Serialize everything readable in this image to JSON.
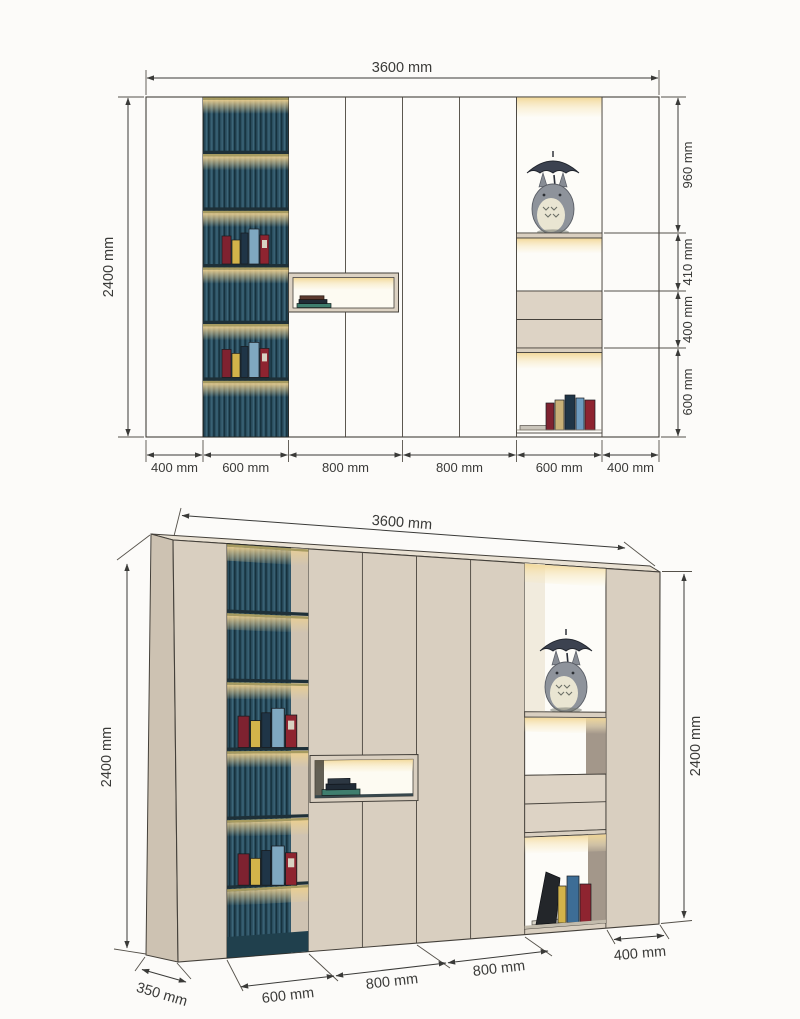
{
  "page": {
    "title": "Wall cabinet dimension drawing"
  },
  "colors": {
    "outline": "#44403a",
    "panel_beige": "#dcd2c3",
    "panel_shadow": "#cdc2b2",
    "slat_teal": "#2d5163",
    "slat_dark": "#16323e",
    "glow_yellow": "#f2d795",
    "niche_white": "#fdfcf8",
    "inner_wall_shadow": "#a3978a",
    "shelf_board_dark": "#1e3038",
    "dim_text": "#3a3a38"
  },
  "elevation": {
    "dim_width": "3600 mm",
    "dim_height": "2400 mm",
    "right_dims": [
      "960 mm",
      "410 mm",
      "400 mm",
      "600 mm"
    ],
    "bottom_dims": [
      "400 mm",
      "600 mm",
      "800 mm",
      "800 mm",
      "600 mm",
      "400 mm"
    ]
  },
  "perspective": {
    "dim_width": "3600 mm",
    "dim_height_left": "2400 mm",
    "dim_height_right": "2400 mm",
    "dim_depth": "350 mm",
    "bottom_dims": [
      "600 mm",
      "800 mm",
      "800 mm"
    ],
    "dim_right_bottom": "400 mm"
  }
}
